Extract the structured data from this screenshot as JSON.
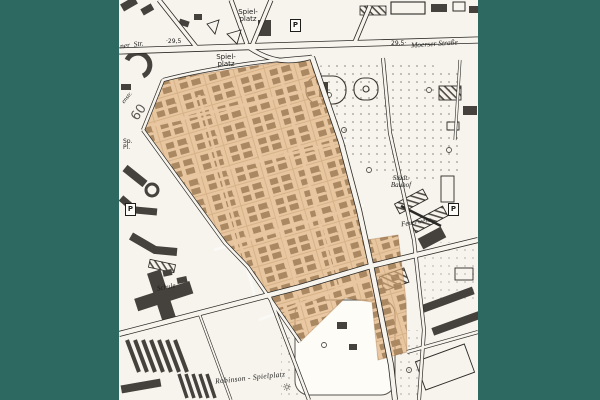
{
  "theme": {
    "border_color": "#2d6961",
    "map_background": "#f7f4ee",
    "highlight_color": "#e0b07a",
    "ink_color": "#1e1d1a"
  },
  "labels": {
    "spielplatz_north": {
      "line1": "Spiel-",
      "line2": "platz"
    },
    "spielplatz_mid": {
      "line1": "Spiel-",
      "line2": "platz"
    },
    "moerser_strasse": "Moerser Straße",
    "ner_str": "ner  Str.",
    "elev_left": "·29,5",
    "elev_right": "29,5·",
    "sp_pl": {
      "line1": "Sp.",
      "line2": "Pl."
    },
    "num60": "60",
    "enstr": "enstr.",
    "staedt_bauhof": {
      "line1": "Städt.",
      "line2": "Bauhof"
    },
    "feuerwehr": "Feuerwehr",
    "schule": "Schule",
    "robinson": "Robinson - Spielplatz",
    "parking": "P",
    "sun": "☼"
  }
}
